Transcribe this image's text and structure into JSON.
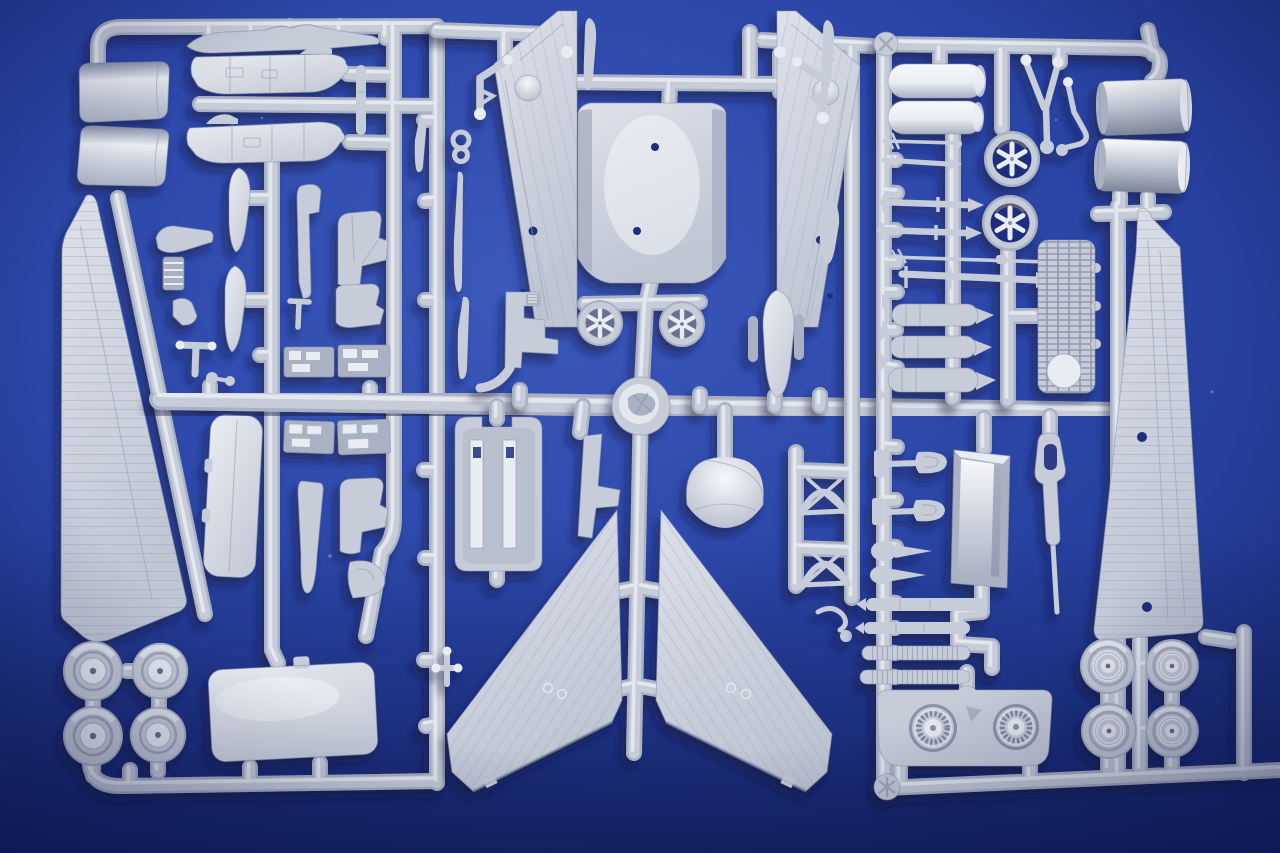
{
  "scene": {
    "description": "Photograph of three light-gray injection-molded plastic model kit sprues with unassembled jet aircraft parts on a blue background",
    "sprues": [
      {
        "name": "left-sprue",
        "parts": [
          "intake-duct-half-a",
          "intake-duct-half-b",
          "fuselage-spine",
          "rear-fuselage-half-a",
          "rear-fuselage-half-b",
          "drop-tank-half-a",
          "drop-tank-half-b",
          "keel-strip",
          "ejection-seat-a",
          "ejection-seat-b",
          "wing-flap-small",
          "radiator-block",
          "linkage-foot",
          "seat-frame",
          "control-column",
          "cockpit-console-a",
          "cockpit-console-b",
          "cockpit-console-c",
          "cockpit-console-d",
          "cockpit-bulkhead",
          "pylon-blade",
          "ejection-seat-c",
          "hook-arm",
          "tail-fin-large",
          "main-wheel-1",
          "main-wheel-2",
          "main-wheel-3",
          "main-wheel-4",
          "hatch-panel-large",
          "peg-bomb",
          "thin-blade"
        ]
      },
      {
        "name": "center-sprue",
        "parts": [
          "fuselage-panel-left",
          "fuselage-panel-right",
          "wing-center-section",
          "pitot-blade-left",
          "pitot-blade-right",
          "canopy-frame-bracket",
          "nose-gear-leg-left",
          "nose-gear-leg-right",
          "link-eyelet",
          "slat-blade-a",
          "slat-blade-b",
          "drop-tank-small",
          "cockpit-step-console",
          "exhaust-elbow",
          "spoked-wheel-left",
          "spoked-wheel-right",
          "rocket-pod",
          "windscreen-dome",
          "cockpit-tub",
          "rudder-small",
          "delta-wing-left",
          "delta-wing-right",
          "gear-door-bow-a",
          "gear-door-bow-b",
          "hook-links",
          "anchor-fitting",
          "sprue-hub"
        ]
      },
      {
        "name": "right-sprue",
        "parts": [
          "fuel-tank-cylinder-a",
          "fuel-tank-cylinder-b",
          "gear-tripod-strut",
          "gear-knee-arm",
          "engine-cowl-cylinder-a",
          "engine-cowl-cylinder-b",
          "intake-fan-ring-a",
          "intake-fan-ring-b",
          "aerial-rod",
          "rocket-small",
          "missile-a",
          "missile-b",
          "pitot-boom",
          "missile-c",
          "bomb-a",
          "bomb-b",
          "bomb-c",
          "grate-panel",
          "fork-clevis-a",
          "fork-clevis-b",
          "bomblet-pair",
          "torpedo-rod-a",
          "torpedo-rod-b",
          "ribbed-roller-a",
          "ribbed-roller-b",
          "open-box-bay",
          "strap-paddle",
          "engine-fan-panel",
          "road-wheel-1",
          "road-wheel-2",
          "road-wheel-3",
          "road-wheel-4",
          "wing-panel-large",
          "corner-boss",
          "star-boss"
        ]
      }
    ]
  },
  "colors": {
    "bg_bright": "#3c59bc",
    "bg_main": "#2a45a6",
    "bg_deep": "#1d3183",
    "bg_dark": "#111d5c",
    "hole": "#1c2f7d",
    "plastic": "#c6ccd8",
    "plastic_light": "#e9ecf2",
    "plastic_bright": "#f7f8fb",
    "plastic_mid": "#a9b1c2",
    "plastic_dark": "#8a93a9",
    "plastic_deep": "#697190",
    "line": "#98a1b5",
    "wing_hi": "#dde1ea",
    "wing_lo": "#bec5d3",
    "silver_top": "#f4f5f8",
    "silver_mid": "#c4cad6",
    "silver_dark": "#7d8699",
    "rim_warm": "#9a8a74",
    "shadow": "#0a1036"
  }
}
